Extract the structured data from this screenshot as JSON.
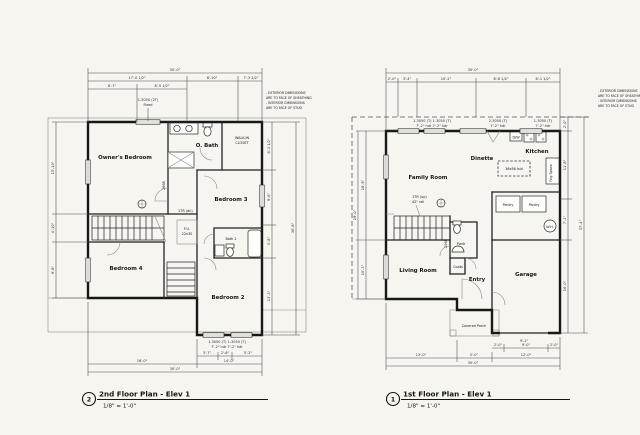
{
  "canvas": {
    "background": "#f6f5f0",
    "ink": "#181818"
  },
  "note": {
    "line1": "- EXTERIOR DIMENSIONS",
    "line2": "ARE TO FACE OF SHEATHING",
    "line3": "- INTERIOR DIMENSIONS",
    "line4": "ARE TO FACE OF STUD"
  },
  "plans": [
    {
      "bubble": "2",
      "title": "2nd Floor Plan - Elev 1",
      "scale": "1/8\" = 1'-0\"",
      "rooms": {
        "owners_bedroom": "Owner's Bedroom",
        "o_bath": "O. Bath",
        "wic1": "WALK-IN",
        "wic2": "CLOSET",
        "bedroom3": "Bedroom 3",
        "bedroom4": "Bedroom 4",
        "bath2": "Bath 2",
        "bedroom2": "Bedroom 2",
        "attic1": "F.U.",
        "attic2": "22x30",
        "stair_note": "17R (dn)",
        "door_tag": "2668"
      },
      "windows": {
        "w_top1": "1-3050 (2T)",
        "w_top2": "Fixed",
        "w_bottom": "1-3050 (T)   1-3050 (T)",
        "w_bottom_hdr": "7'-2\" hdr    7'-2\" hdr"
      },
      "dims": {
        "overall_top": "30'-0\"",
        "top_a": "17'-0 1/2\"",
        "top_b": "8'-10\"",
        "top_c": "7'-3 1/2\"",
        "top_d": "8'-7\"",
        "top_e": "8'-5 1/2\"",
        "left_a": "15'-10\"",
        "left_b": "4'-10\"",
        "left_c": "9'-8\"",
        "right_a": "8'-3 1/2\"",
        "right_b": "9'-6\"",
        "right_c": "5'-8\"",
        "right_d": "13'-3\"",
        "right_overall": "36'-8\"",
        "bot_a": "3'-7\"",
        "bot_b": "2'-6\"",
        "bot_c": "5'-2\"",
        "bot_left": "16'-0\"",
        "bot_right": "14'-0\"",
        "overall_bottom": "30'-0\""
      }
    },
    {
      "bubble": "1",
      "title": "1st Floor Plan - Elev 1",
      "scale": "1/8\" = 1'-0\"",
      "rooms": {
        "family_room": "Family Room",
        "dinette": "Dinette",
        "kitchen": "Kitchen",
        "living_room": "Living Room",
        "pwdr": "Pwdr",
        "coats": "Coats",
        "entry": "Entry",
        "garage": "Garage",
        "covered_porch": "Covered Porch",
        "island": "36x56 Isld",
        "dw": "D/W",
        "frig": "Frig Space",
        "pantry1": "Pantry",
        "pantry2": "Pantry",
        "wh": "W.H.",
        "stair_note": "17R (up)",
        "rail_note": "42\" rail",
        "door_tag": "2068"
      },
      "windows": {
        "w_top1": "1-3050 (T)  1-3050 (T)",
        "w_top1_hdr": "7'-2\" hdr   7'-2\" hdr",
        "w_top2": "2-3050 (T)",
        "w_top2_hdr": "7'-2\" hdr",
        "w_top3": "1-3050 (T)",
        "w_top3_hdr": "7'-2\" hdr"
      },
      "dims": {
        "overall_top": "30'-0\"",
        "top_a": "2'-0\"",
        "top_b": "3'-4\"",
        "top_c": "10'-2\"",
        "top_d": "8'-6 1/2\"",
        "top_e": "6'-1 1/2\"",
        "left_a": "18'-9\"",
        "left_b": "10'-3\"",
        "left_overall": "29'-0\"",
        "right_a": "2'-0\"",
        "right_b": "11'-8\"",
        "right_c": "7'-1\"",
        "right_d": "16'-0\"",
        "right_overall": "37'-4\"",
        "garage_door": "9'-1\"",
        "gd_a": "2'-0\"",
        "gd_b": "9'-0\"",
        "gd_c": "2'-0\"",
        "bot_a": "13'-0\"",
        "bot_b": "5'-0\"",
        "bot_c": "12'-0\"",
        "overall_bottom": "30'-0\""
      }
    }
  ]
}
